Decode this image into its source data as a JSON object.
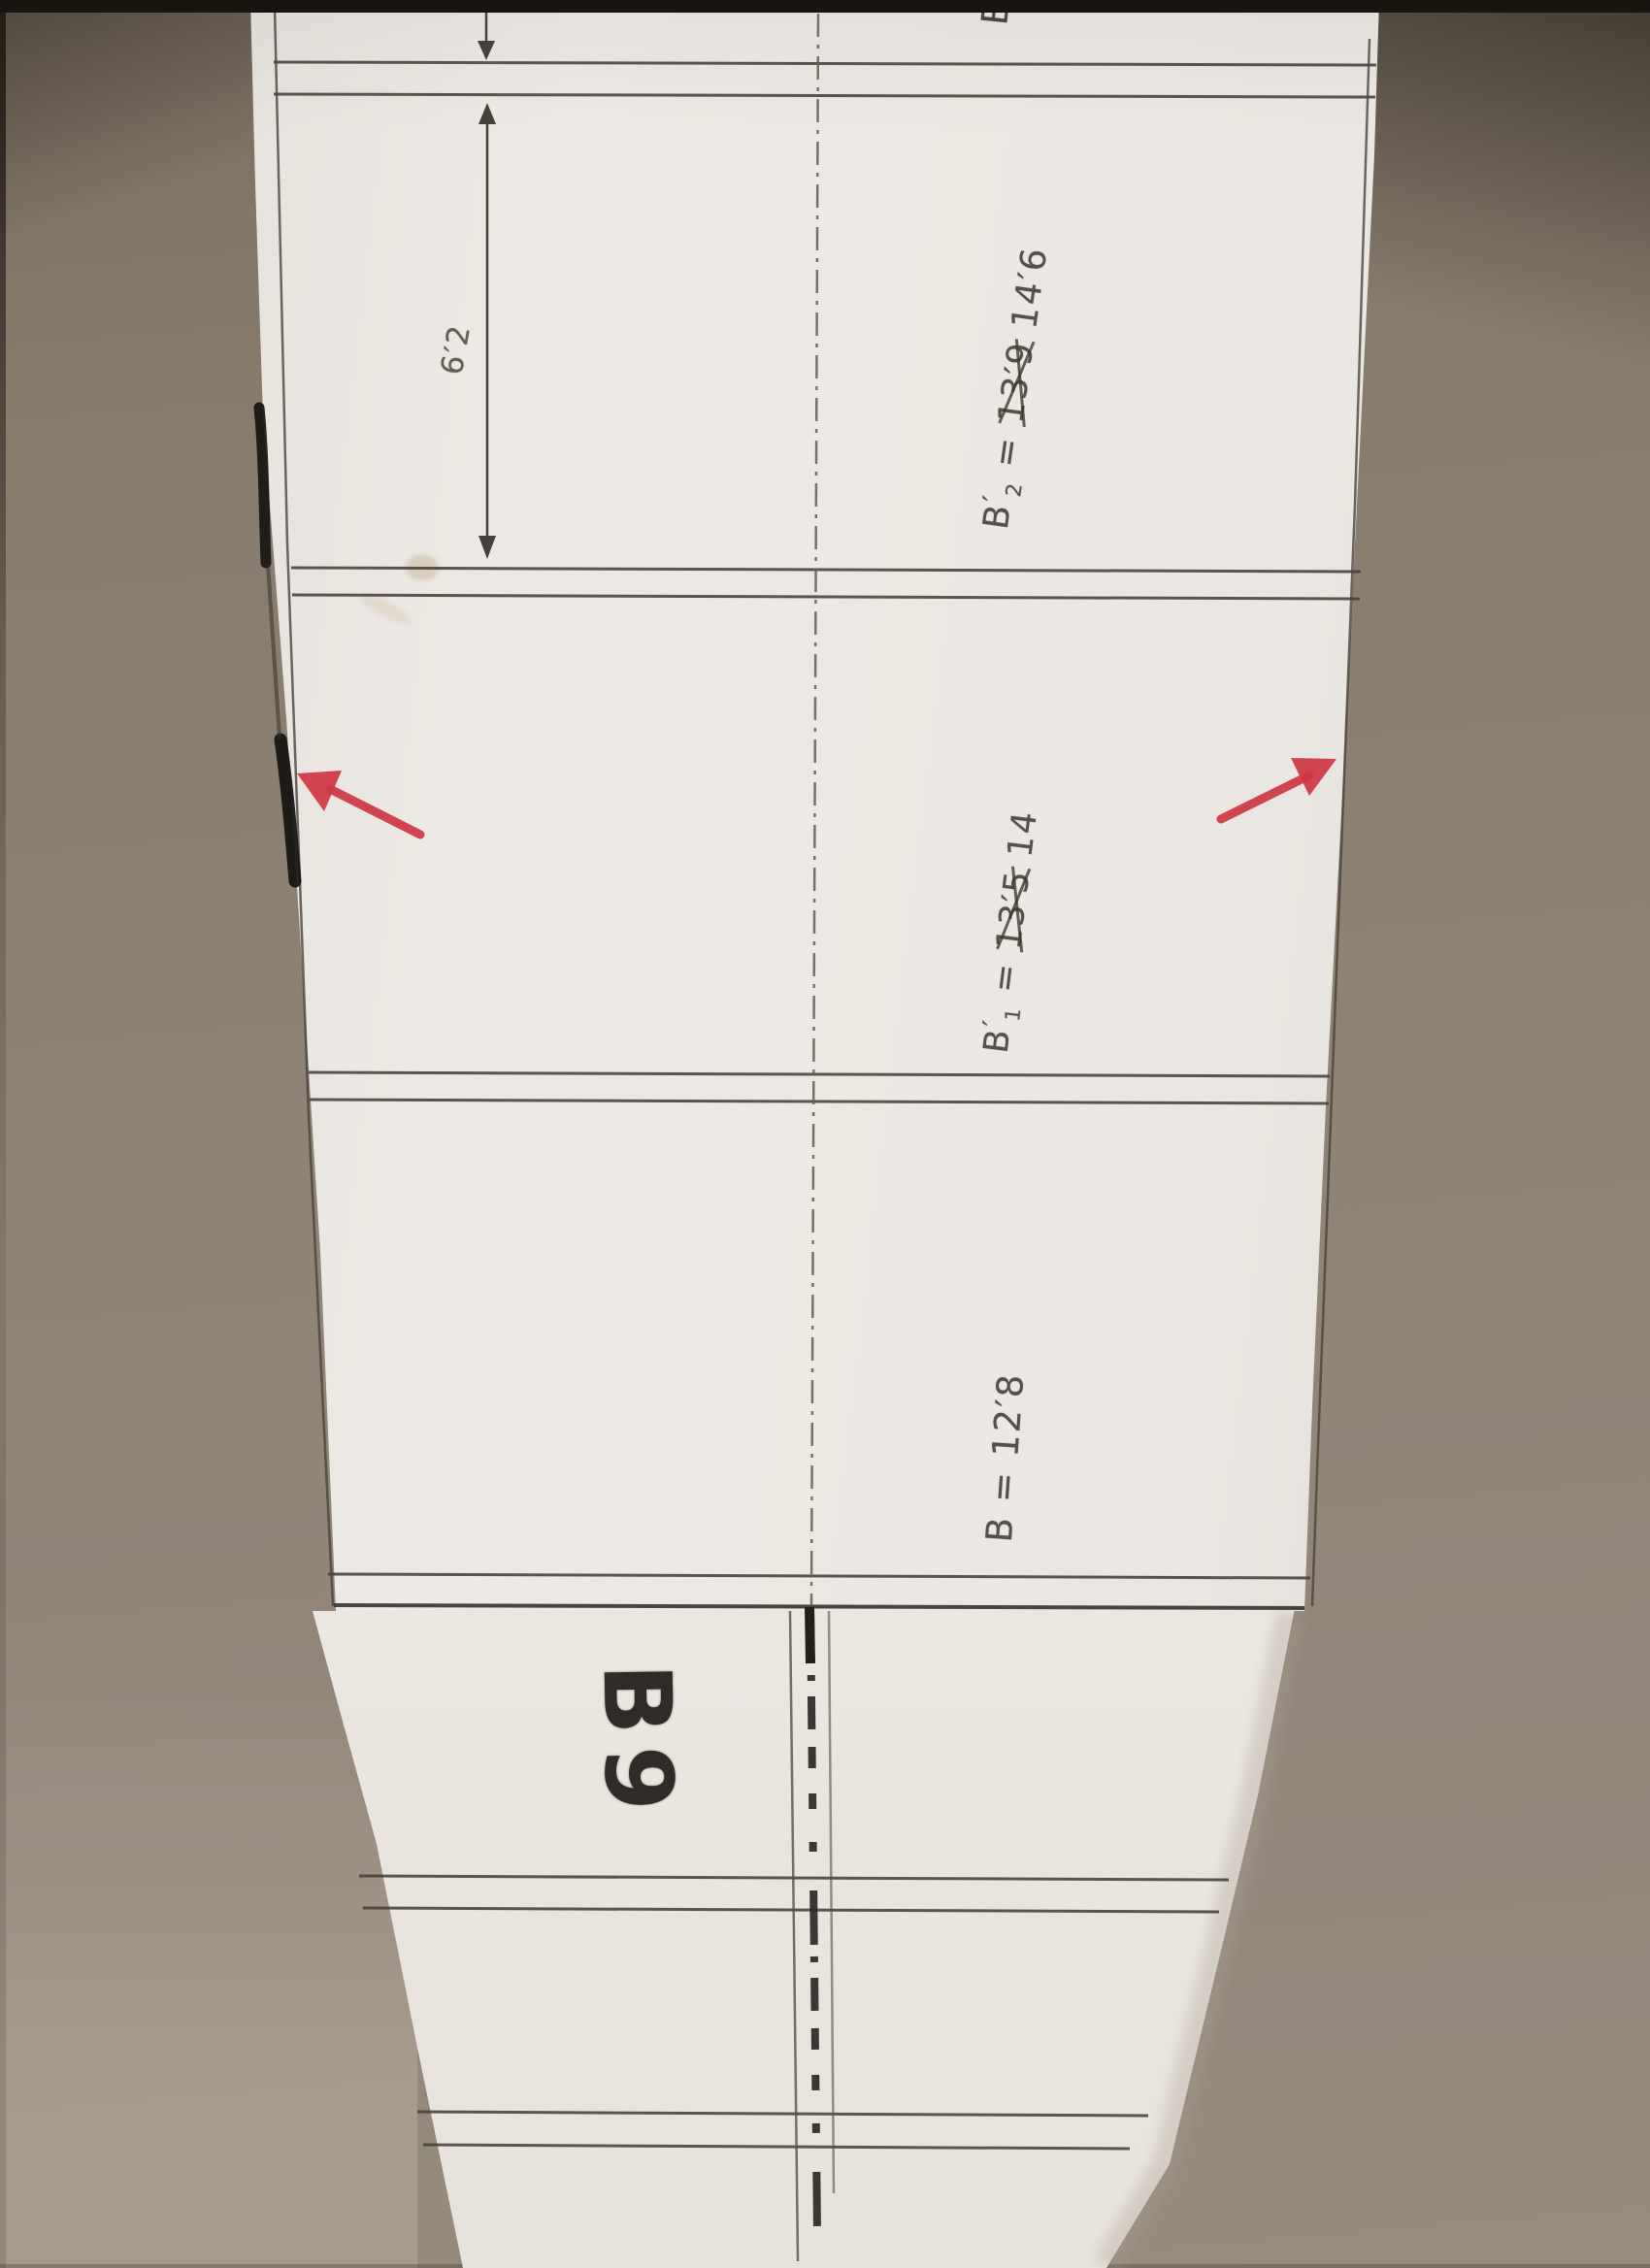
{
  "labels": {
    "piece": "B9",
    "edge_partial": "B",
    "dimension": "6′2"
  },
  "measurements": [
    {
      "base": "B",
      "prime": "′",
      "sub": "2",
      "eq": "=",
      "struck": "13′9",
      "value": "14′6"
    },
    {
      "base": "B",
      "prime": "′",
      "sub": "1",
      "eq": "=",
      "struck": "13′5",
      "value": "14"
    },
    {
      "base": "B",
      "prime": "",
      "sub": "",
      "eq": "=",
      "struck": "",
      "value": "12′8"
    }
  ],
  "colors": {
    "arrow_red": "#cf3844",
    "pencil": "#46413b",
    "marker_line": "#2c2823",
    "paper": "#eae6e1",
    "background": "#8d8273"
  }
}
